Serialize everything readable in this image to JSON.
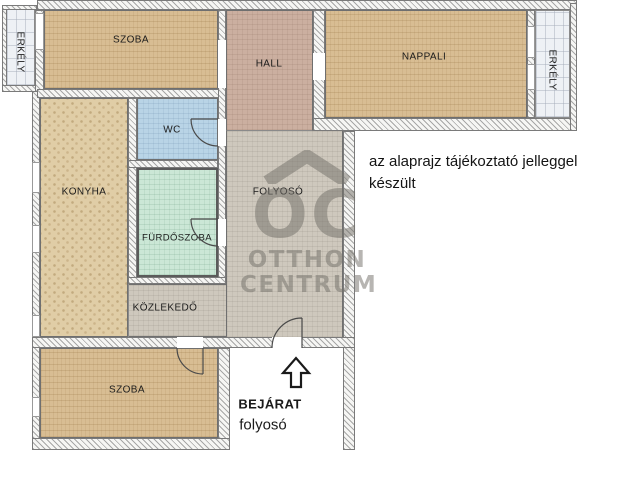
{
  "plan": {
    "rooms": {
      "szoba_top": {
        "label": "SZOBA",
        "color": "#d8bd93"
      },
      "hall": {
        "label": "HALL",
        "color": "#cbafa0"
      },
      "nappali": {
        "label": "NAPPALI",
        "color": "#d8bd93"
      },
      "erkely_left": {
        "label": "ERKÉLY",
        "color": "#eef1f5"
      },
      "erkely_right": {
        "label": "ERKÉLY",
        "color": "#eef1f5"
      },
      "konyha": {
        "label": "KONYHA",
        "color": "#e0cda6"
      },
      "wc": {
        "label": "WC",
        "color": "#b9d4e6"
      },
      "furdoszoba": {
        "label": "FÜRDŐSZOBA",
        "color": "#cbe7d6"
      },
      "folyoso": {
        "label": "FOLYOSÓ",
        "color": "#cec8bd"
      },
      "kozlekedo": {
        "label": "KÖZLEKEDŐ",
        "color": "#cec8bd"
      },
      "szoba_bottom": {
        "label": "SZOBA",
        "color": "#d8bd93"
      }
    },
    "entrance": {
      "label": "BEJÁRAT",
      "sublabel": "folyosó"
    },
    "disclaimer": "az alaprajz tájékoztató jelleggel készült",
    "watermark": {
      "monogram": "OC",
      "line1": "OTTHON",
      "line2": "CENTRUM",
      "color": "#76736c"
    }
  }
}
